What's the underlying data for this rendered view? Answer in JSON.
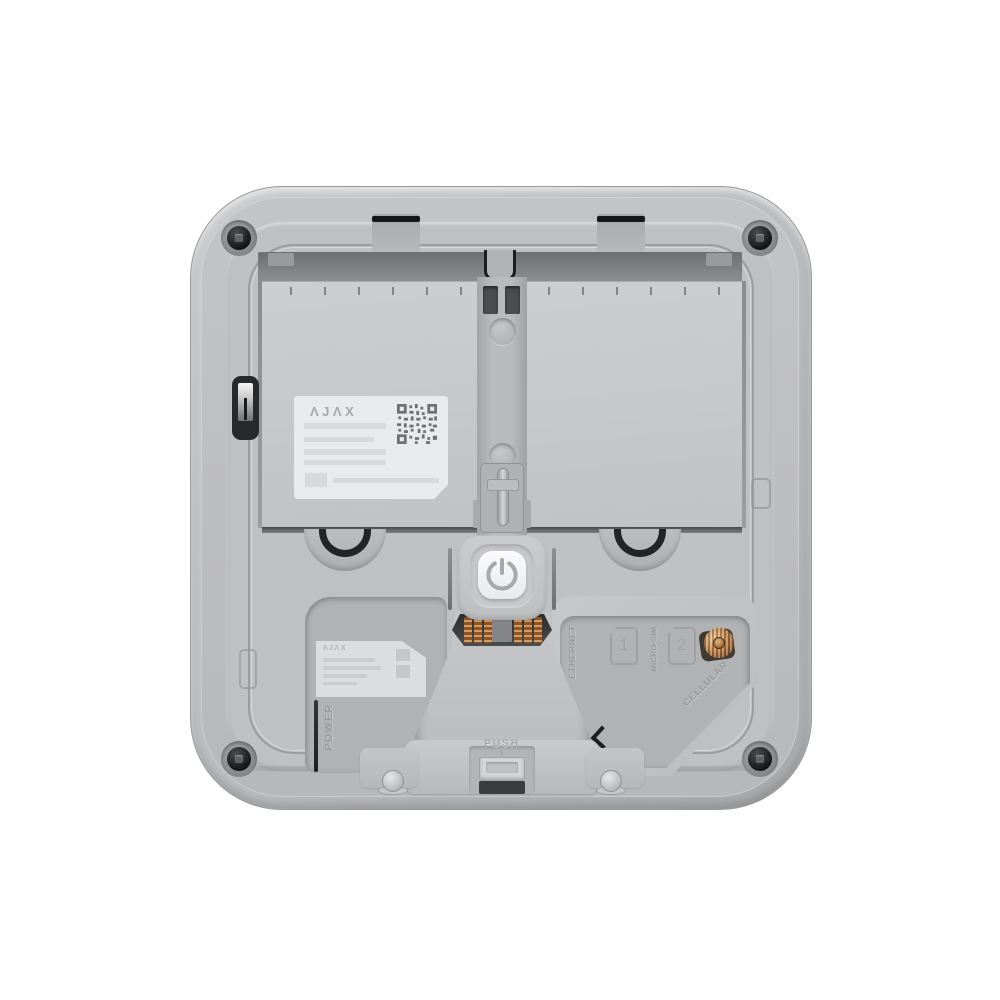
{
  "product": {
    "name": "ajax-hub-back-panel",
    "logo_main": "ΛJΛX",
    "logo_small": "ΛJΛX",
    "labels": {
      "power": "POWER",
      "ethernet": "ETHERNET",
      "micro_sim": "MICRO-SIM",
      "sim_slot_1": "1",
      "sim_slot_2": "2",
      "cellular": "CELLULAR",
      "push": "PUSH",
      "push_arrow": "▾"
    },
    "colors": {
      "background": "#ffffff",
      "body": "#bcbdbf",
      "panel_light": "#c9cacc",
      "recess": "#b1b2b4",
      "dark_band": "#77787a",
      "black_detail": "#1e1f21",
      "sticker": "#e9eaeb",
      "label_text": "#96979a",
      "copper": "#b5723c",
      "button_face": "#f4f5f6"
    }
  }
}
